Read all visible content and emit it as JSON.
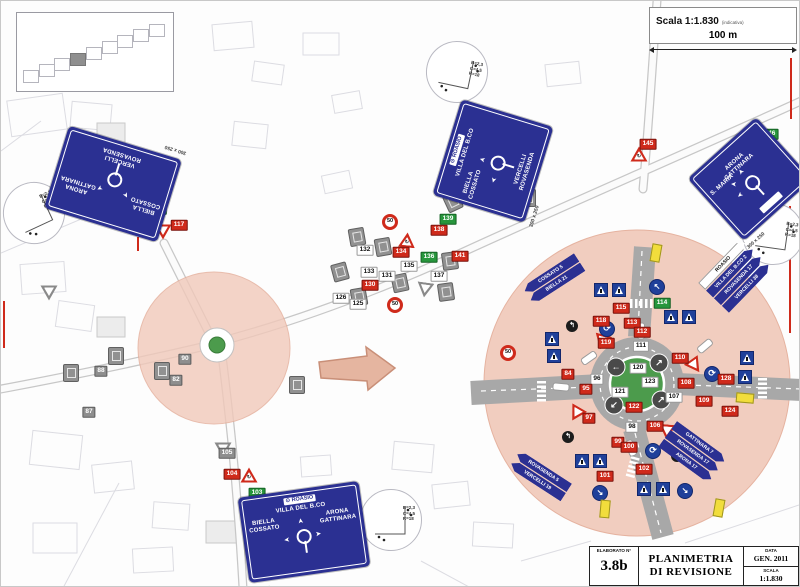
{
  "scale_box": {
    "label": "Scala 1:1.830",
    "suffix": "(indicativa)",
    "distance": "100 m"
  },
  "title_block": {
    "elaborato_label": "ELABORATO N°",
    "elaborato_value": "3.8b",
    "title_line1": "PLANIMETRIA",
    "title_line2": "DI REVISIONE",
    "data_label": "DATA",
    "data_value": "GEN. 2011",
    "scala_label": "SCALA",
    "scala_value": "1:1.830"
  },
  "detail_note": {
    "lines": [
      "B=2,3",
      "C=4,5",
      "R=18"
    ]
  },
  "colors": {
    "panel_blue": "#2b3092",
    "new_sign_red": "#cf2a1b",
    "existing_gray": "#8a8a8a",
    "added_green": "#27963c",
    "zone_salmon": "#f1c9ba",
    "island_green": "#4c9b4c"
  },
  "inset": {
    "squares": 9,
    "filled_index": 3
  },
  "panel_signs": [
    {
      "id": "nw",
      "x": 112,
      "y": 183,
      "w": 118,
      "h": 86,
      "rot": 197,
      "left": [
        "BIELLA",
        "COSSATO"
      ],
      "right": [
        "ARONA",
        "GATTINARA"
      ],
      "bottom": [
        "VERCELLI",
        "ROVASENDA"
      ],
      "arrows": [
        "upleft",
        "upright"
      ],
      "note": "300 x 250"
    },
    {
      "id": "center",
      "x": 492,
      "y": 160,
      "w": 100,
      "h": 96,
      "rot": -73,
      "topbox": "ROASIO",
      "top": [
        "VILLA DEL B.CO"
      ],
      "left": [
        "BIELLA",
        "COSSATO"
      ],
      "bottom": [
        "VERCELLI",
        "ROVASENDA"
      ],
      "arrows": [
        "up",
        "left"
      ],
      "note": "300 x 250"
    },
    {
      "id": "east",
      "x": 749,
      "y": 178,
      "w": 92,
      "h": 84,
      "rot": -42,
      "top": [
        "ARONA",
        "GATTINARA"
      ],
      "left": [
        "S. MARIA"
      ],
      "arrows": [
        "up",
        "upleft",
        "left"
      ],
      "botbox": true,
      "note": "300 x 250"
    },
    {
      "id": "south",
      "x": 303,
      "y": 531,
      "w": 122,
      "h": 86,
      "rot": -8,
      "topbox": "ROASIO",
      "top": [
        "VILLA DEL B.CO"
      ],
      "left": [
        "BIELLA",
        "COSSATO"
      ],
      "right": [
        "ARONA",
        "GATTINARA"
      ],
      "arrows": [
        "up",
        "left",
        "right"
      ],
      "note": "300 x 250"
    }
  ],
  "flag_stacks": [
    {
      "x": 521,
      "y": 286,
      "rot": -33,
      "dir": "left",
      "items": [
        {
          "t": "COSSATO 5",
          "c": "b"
        },
        {
          "t": "BIELLA 21",
          "c": "b"
        }
      ]
    },
    {
      "x": 519,
      "y": 449,
      "rot": 33,
      "dir": "left",
      "items": [
        {
          "t": "ROVASENDA 5",
          "c": "b"
        },
        {
          "t": "VERCELLI 19",
          "c": "b"
        }
      ]
    },
    {
      "x": 697,
      "y": 282,
      "rot": -46,
      "dir": "right",
      "items": [
        {
          "t": "ROASIO",
          "c": "w"
        },
        {
          "t": "VILLA DEL B.CO 2",
          "c": "b"
        },
        {
          "t": "ROVASENDA 17",
          "c": "b"
        },
        {
          "t": "VERCELLI 38",
          "c": "b"
        }
      ]
    },
    {
      "x": 676,
      "y": 420,
      "rot": 36,
      "dir": "right",
      "items": [
        {
          "t": "GATTINARA 7",
          "c": "b"
        },
        {
          "t": "ROVASENDA 17",
          "c": "b"
        },
        {
          "t": "ARONA 17",
          "c": "b"
        }
      ]
    }
  ],
  "number_tags": [
    {
      "n": "116",
      "c": "g",
      "x": 157,
      "y": 208
    },
    {
      "n": "117",
      "c": "r",
      "x": 178,
      "y": 224
    },
    {
      "n": "143",
      "c": "r",
      "x": 503,
      "y": 194
    },
    {
      "n": "145",
      "c": "r",
      "x": 647,
      "y": 143
    },
    {
      "n": "146",
      "c": "g",
      "x": 769,
      "y": 133
    },
    {
      "n": "88",
      "c": "gy",
      "x": 100,
      "y": 370
    },
    {
      "n": "87",
      "c": "gy",
      "x": 88,
      "y": 411
    },
    {
      "n": "90",
      "c": "gy",
      "x": 184,
      "y": 358
    },
    {
      "n": "82",
      "c": "gy",
      "x": 175,
      "y": 379
    },
    {
      "n": "105",
      "c": "gy",
      "x": 226,
      "y": 452
    },
    {
      "n": "104",
      "c": "r",
      "x": 231,
      "y": 473
    },
    {
      "n": "103",
      "c": "g",
      "x": 256,
      "y": 492
    },
    {
      "n": "132",
      "c": "w",
      "x": 364,
      "y": 249
    },
    {
      "n": "133",
      "c": "w",
      "x": 368,
      "y": 271
    },
    {
      "n": "131",
      "c": "w",
      "x": 386,
      "y": 275
    },
    {
      "n": "135",
      "c": "w",
      "x": 408,
      "y": 265
    },
    {
      "n": "137",
      "c": "w",
      "x": 438,
      "y": 275
    },
    {
      "n": "130",
      "c": "r",
      "x": 369,
      "y": 284
    },
    {
      "n": "134",
      "c": "r",
      "x": 400,
      "y": 251
    },
    {
      "n": "136",
      "c": "g",
      "x": 428,
      "y": 256
    },
    {
      "n": "138",
      "c": "r",
      "x": 438,
      "y": 229
    },
    {
      "n": "139",
      "c": "g",
      "x": 447,
      "y": 218
    },
    {
      "n": "141",
      "c": "r",
      "x": 459,
      "y": 255
    },
    {
      "n": "125",
      "c": "w",
      "x": 357,
      "y": 303
    },
    {
      "n": "126",
      "c": "w",
      "x": 340,
      "y": 297
    },
    {
      "n": "115",
      "c": "r",
      "x": 620,
      "y": 307
    },
    {
      "n": "113",
      "c": "r",
      "x": 631,
      "y": 322
    },
    {
      "n": "112",
      "c": "r",
      "x": 641,
      "y": 331
    },
    {
      "n": "118",
      "c": "r",
      "x": 600,
      "y": 320
    },
    {
      "n": "114",
      "c": "g",
      "x": 661,
      "y": 302
    },
    {
      "n": "119",
      "c": "r",
      "x": 605,
      "y": 342
    },
    {
      "n": "111",
      "c": "w",
      "x": 640,
      "y": 345
    },
    {
      "n": "110",
      "c": "r",
      "x": 679,
      "y": 357
    },
    {
      "n": "128",
      "c": "r",
      "x": 725,
      "y": 378
    },
    {
      "n": "84",
      "c": "r",
      "x": 567,
      "y": 373
    },
    {
      "n": "96",
      "c": "w",
      "x": 596,
      "y": 378
    },
    {
      "n": "95",
      "c": "r",
      "x": 585,
      "y": 388
    },
    {
      "n": "108",
      "c": "r",
      "x": 685,
      "y": 382
    },
    {
      "n": "107",
      "c": "w",
      "x": 673,
      "y": 396
    },
    {
      "n": "109",
      "c": "r",
      "x": 703,
      "y": 400
    },
    {
      "n": "120",
      "c": "w",
      "x": 637,
      "y": 367
    },
    {
      "n": "121",
      "c": "w",
      "x": 619,
      "y": 391
    },
    {
      "n": "122",
      "c": "r",
      "x": 633,
      "y": 406
    },
    {
      "n": "123",
      "c": "w",
      "x": 649,
      "y": 381
    },
    {
      "n": "97",
      "c": "r",
      "x": 588,
      "y": 417
    },
    {
      "n": "98",
      "c": "w",
      "x": 631,
      "y": 426
    },
    {
      "n": "106",
      "c": "r",
      "x": 654,
      "y": 425
    },
    {
      "n": "99",
      "c": "r",
      "x": 617,
      "y": 441
    },
    {
      "n": "100",
      "c": "r",
      "x": 628,
      "y": 446
    },
    {
      "n": "101",
      "c": "r",
      "x": 604,
      "y": 475
    },
    {
      "n": "102",
      "c": "r",
      "x": 643,
      "y": 468
    },
    {
      "n": "124",
      "c": "r",
      "x": 729,
      "y": 410
    }
  ],
  "icons": [
    {
      "t": "yield",
      "x": 601,
      "y": 341,
      "r": 15
    },
    {
      "t": "yield",
      "x": 694,
      "y": 365,
      "r": -35
    },
    {
      "t": "yield",
      "x": 666,
      "y": 431,
      "r": 5
    },
    {
      "t": "yield",
      "x": 575,
      "y": 413,
      "r": 30
    },
    {
      "t": "yield",
      "x": 162,
      "y": 231,
      "r": 0
    },
    {
      "t": "gyield",
      "x": 222,
      "y": 449,
      "r": 0
    },
    {
      "t": "gyield",
      "x": 48,
      "y": 292,
      "r": 0
    },
    {
      "t": "gyield",
      "x": 424,
      "y": 289,
      "r": 8
    },
    {
      "t": "warnrb",
      "x": 406,
      "y": 239,
      "r": 5
    },
    {
      "t": "warnrb",
      "x": 248,
      "y": 474,
      "r": 0
    },
    {
      "t": "warnrb",
      "x": 638,
      "y": 153,
      "r": 0
    },
    {
      "t": "c50",
      "x": 389,
      "y": 221,
      "r": 0
    },
    {
      "t": "c50",
      "x": 394,
      "y": 304,
      "r": 0
    },
    {
      "t": "c50",
      "x": 507,
      "y": 352,
      "r": 0
    },
    {
      "t": "rnd",
      "x": 606,
      "y": 328,
      "r": 0
    },
    {
      "t": "rnd",
      "x": 652,
      "y": 450,
      "r": 0
    },
    {
      "t": "rnd",
      "x": 711,
      "y": 373,
      "r": 0
    },
    {
      "t": "keep",
      "x": 656,
      "y": 286,
      "r": 0,
      "g": "↖"
    },
    {
      "t": "keep",
      "x": 599,
      "y": 492,
      "r": 0,
      "g": "↘"
    },
    {
      "t": "keep",
      "x": 684,
      "y": 490,
      "r": 0,
      "g": "↘"
    },
    {
      "t": "blk",
      "x": 571,
      "y": 325,
      "r": 0,
      "g": "↰"
    },
    {
      "t": "blk",
      "x": 567,
      "y": 436,
      "r": 0,
      "g": "↰"
    },
    {
      "t": "blk",
      "x": 676,
      "y": 455,
      "r": 0,
      "g": "↱"
    },
    {
      "t": "isl",
      "x": 615,
      "y": 366,
      "r": 0,
      "g": "←"
    },
    {
      "t": "isl",
      "x": 658,
      "y": 362,
      "r": 0,
      "g": "↗"
    },
    {
      "t": "isl",
      "x": 613,
      "y": 404,
      "r": 0,
      "g": "↙"
    },
    {
      "t": "isl",
      "x": 660,
      "y": 399,
      "r": 0,
      "g": "↗"
    },
    {
      "t": "ped",
      "x": 600,
      "y": 289,
      "r": 0
    },
    {
      "t": "ped",
      "x": 618,
      "y": 289,
      "r": 0
    },
    {
      "t": "ped",
      "x": 581,
      "y": 460,
      "r": 0
    },
    {
      "t": "ped",
      "x": 599,
      "y": 460,
      "r": 0
    },
    {
      "t": "ped",
      "x": 643,
      "y": 488,
      "r": 0
    },
    {
      "t": "ped",
      "x": 662,
      "y": 488,
      "r": 0
    },
    {
      "t": "ped",
      "x": 670,
      "y": 316,
      "r": 0
    },
    {
      "t": "ped",
      "x": 688,
      "y": 316,
      "r": 0
    },
    {
      "t": "ped",
      "x": 746,
      "y": 357,
      "r": 0
    },
    {
      "t": "ped",
      "x": 744,
      "y": 376,
      "r": 0
    },
    {
      "t": "ped",
      "x": 551,
      "y": 338,
      "r": 0
    },
    {
      "t": "ped",
      "x": 553,
      "y": 355,
      "r": 0
    },
    {
      "t": "bus",
      "x": 655,
      "y": 252,
      "r": 100
    },
    {
      "t": "bus",
      "x": 744,
      "y": 397,
      "r": 5
    },
    {
      "t": "bus",
      "x": 604,
      "y": 508,
      "r": 95
    },
    {
      "t": "bus",
      "x": 718,
      "y": 507,
      "r": 100
    },
    {
      "t": "cap",
      "x": 640,
      "y": 330,
      "r": 90
    },
    {
      "t": "cap",
      "x": 560,
      "y": 386,
      "r": 5
    },
    {
      "t": "cap",
      "x": 630,
      "y": 447,
      "r": 70
    },
    {
      "t": "cap",
      "x": 588,
      "y": 357,
      "r": -35
    },
    {
      "t": "cap",
      "x": 704,
      "y": 345,
      "r": -40
    },
    {
      "t": "gs",
      "x": 356,
      "y": 236,
      "r": -10
    },
    {
      "t": "gs",
      "x": 382,
      "y": 246,
      "r": -10
    },
    {
      "t": "gs",
      "x": 339,
      "y": 271,
      "r": -15
    },
    {
      "t": "gs",
      "x": 399,
      "y": 282,
      "r": -12
    },
    {
      "t": "gs",
      "x": 358,
      "y": 296,
      "r": -10
    },
    {
      "t": "gs",
      "x": 445,
      "y": 291,
      "r": -8
    },
    {
      "t": "gs",
      "x": 449,
      "y": 260,
      "r": -8
    },
    {
      "t": "gs",
      "x": 452,
      "y": 201,
      "r": -25
    },
    {
      "t": "gs",
      "x": 115,
      "y": 355,
      "r": 0
    },
    {
      "t": "gs",
      "x": 161,
      "y": 370,
      "r": 0
    },
    {
      "t": "gs",
      "x": 296,
      "y": 384,
      "r": 0
    },
    {
      "t": "gs",
      "x": 70,
      "y": 372,
      "r": 0
    },
    {
      "t": "gs",
      "x": 527,
      "y": 197,
      "r": 0
    }
  ]
}
